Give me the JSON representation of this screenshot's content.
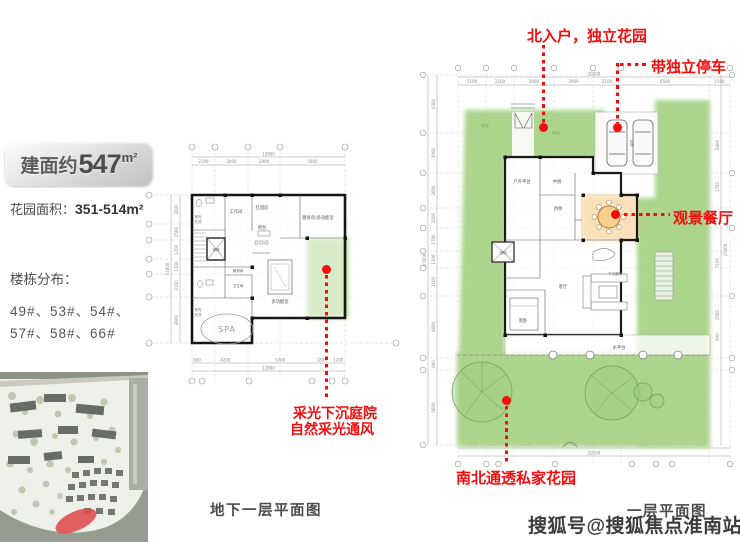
{
  "info_panel": {
    "area_prefix": "建面约",
    "area_value": "547",
    "area_unit": "m²",
    "garden_label": "花园面积：",
    "garden_value": "351-514m²",
    "distribution_label": "楼栋分布：",
    "buildings_line1": "49#、53#、54#、",
    "buildings_line2": "57#、58#、66#"
  },
  "annotations": {
    "north_entry": "北入户，独立花园",
    "parking": "带独立停车",
    "scenic_dining": "观景餐厅",
    "sunken_line1": "采光下沉庭院",
    "sunken_line2": "自然采光通风",
    "private_garden": "南北通透私家花园"
  },
  "basement": {
    "caption": "地下一层平面图",
    "rooms": {
      "work": "工作间",
      "wine": "红酒房",
      "bar": "吧台",
      "elevator": "电梯",
      "storage": "储物间",
      "toilet": "卫生间",
      "gym": "健身房/多功能室",
      "multi": "多功能室",
      "spa": "SPA",
      "lightwell_a": "采光",
      "lightwell_b": "天井"
    },
    "dims_top": [
      "2100",
      "3000",
      "2900",
      "5800"
    ],
    "total_top": "13800",
    "dims_bottom": [
      "900",
      "4200",
      "5700",
      "1800",
      "1200"
    ],
    "total_bottom": "13800",
    "dims_left": [
      "2600",
      "1500",
      "1700",
      "1300",
      "2100",
      "4600"
    ],
    "total_left": "13800"
  },
  "first_floor": {
    "caption": "一层平面图",
    "rooms": {
      "outdoor": "户外平台",
      "kitchen_cn": "中厨",
      "kitchen_w": "西厨",
      "living": "客厅",
      "guest_bed": "客卧",
      "elevator": "电梯",
      "garage": "车库",
      "sunken": "下沉庭院",
      "water": "水平台",
      "green1": "绿化",
      "green2": "绿化",
      "green3": "绿化"
    },
    "dims_top": [
      "2100",
      "2100",
      "3000",
      "2900",
      "2100",
      "6500",
      "1500"
    ],
    "total_top": "20200",
    "dims_bottom": [
      "2100",
      "900",
      "4200",
      "5700",
      "1800",
      "1200",
      "4300"
    ],
    "total_bottom": "20200",
    "dims_left": [
      "4300",
      "3000",
      "2600",
      "1500",
      "1700",
      "1300",
      "2100",
      "4600",
      "900",
      "5600"
    ],
    "total_left": "27600",
    "dims_right": [
      "5600",
      "1700",
      "7100",
      "3500",
      "900"
    ]
  },
  "watermark": "搜狐号@搜狐焦点淮南站",
  "colors": {
    "annotation_red": "#f30d0d",
    "garden_green": "#a8d287",
    "dining_orange": "#f0ae45"
  }
}
